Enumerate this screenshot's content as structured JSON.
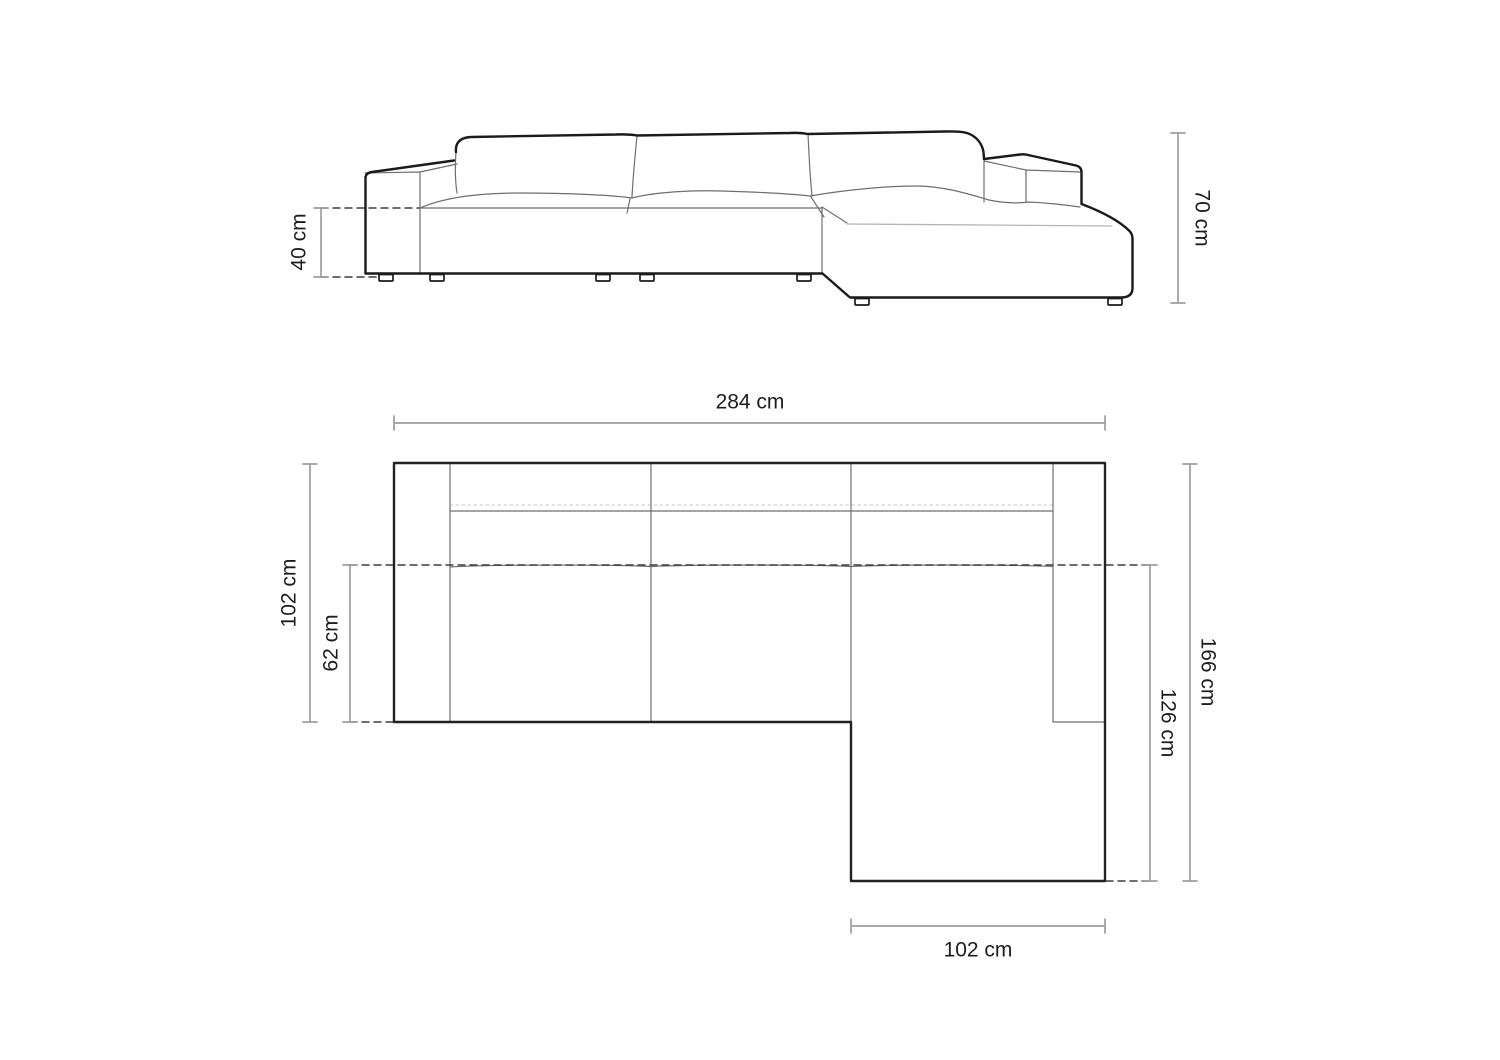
{
  "diagram_title": "sofa-dimension-drawing",
  "colors": {
    "background": "#ffffff",
    "outline": "#1a1a1a",
    "thin_line": "#6e6e6e",
    "light_line": "#b5b5b5",
    "dashed_line": "#3f3f3f",
    "dimension_line": "#9e9e9e",
    "text": "#1d1d1d"
  },
  "front_view": {
    "seat_height_label": "40 cm",
    "overall_height_label": "70 cm"
  },
  "top_view": {
    "overall_width_label": "284 cm",
    "sofa_depth_label": "102 cm",
    "seat_depth_label": "62 cm",
    "overall_depth_label": "166 cm",
    "chaise_depth_label": "126 cm",
    "chaise_width_label": "102 cm"
  }
}
